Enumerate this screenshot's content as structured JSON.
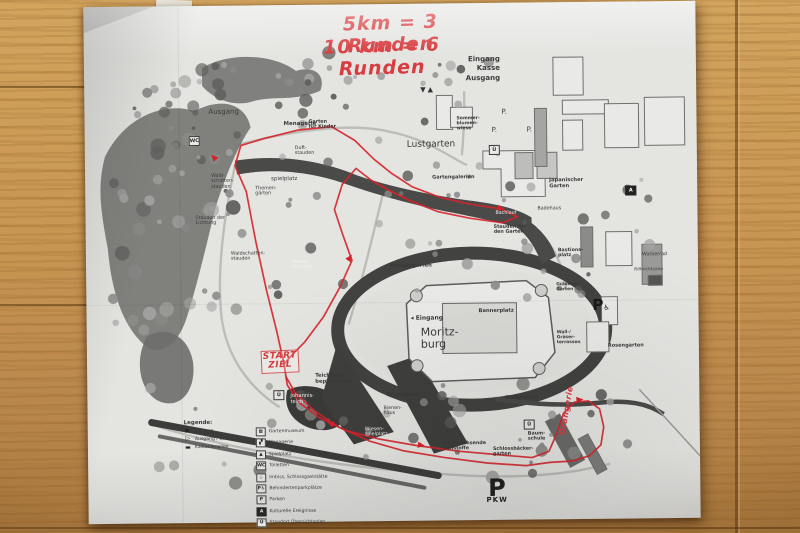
{
  "handwriting": {
    "line1": "5km = 3 Runden",
    "line2": "10 km = 6 Runden",
    "start_ziel": "START\nZIEL",
    "orangerie_note": "Orangerie"
  },
  "colors": {
    "route_red": "#d5232b",
    "handwriting_red": "#d73c40",
    "paper": "#e4e4e1",
    "print_dark": "#3a3a3a",
    "wood": "#c89552"
  },
  "map": {
    "entrance_block": [
      "Eingang",
      "Kasse",
      "Ausgang"
    ],
    "entrance_glyphs": "▼▲",
    "title_castle": "Moritz-\nburg",
    "labels": [
      {
        "t": "Ausgang",
        "x": 124,
        "y": 103,
        "c": "dk",
        "fs": 7
      },
      {
        "t": "Menagerie",
        "x": 199,
        "y": 116,
        "c": "b",
        "fs": 5.5
      },
      {
        "t": "Duft-\nstauden",
        "x": 210,
        "y": 141,
        "c": "",
        "fs": 4.8
      },
      {
        "t": "spielplatz",
        "x": 186,
        "y": 171,
        "c": "",
        "fs": 5.5
      },
      {
        "t": "Themen-\ngärten",
        "x": 170,
        "y": 181,
        "c": "",
        "fs": 4.8
      },
      {
        "t": "Wald-\nschatten-\nstauden",
        "x": 126,
        "y": 168,
        "c": "",
        "fs": 4.8
      },
      {
        "t": "Stauden der\nLichtung",
        "x": 110,
        "y": 210,
        "c": "",
        "fs": 4.8
      },
      {
        "t": "Waldschatten-\nstauden",
        "x": 145,
        "y": 246,
        "c": "",
        "fs": 4.8
      },
      {
        "t": "Rosen/\nStauden",
        "x": 206,
        "y": 255,
        "c": "wh",
        "fs": 4.8
      },
      {
        "t": "Garten\nfür Kinder",
        "x": 224,
        "y": 115,
        "c": "b",
        "fs": 4.8
      },
      {
        "t": "Lustgarten",
        "x": 322,
        "y": 136,
        "c": "",
        "fs": 9
      },
      {
        "t": "Gartengalerien",
        "x": 347,
        "y": 172,
        "c": "b",
        "fs": 5
      },
      {
        "t": "Sommer-\nblumen-\nwiese",
        "x": 372,
        "y": 113,
        "c": "b",
        "fs": 4.6
      },
      {
        "t": "P.",
        "x": 417,
        "y": 106,
        "c": "",
        "fs": 7
      },
      {
        "t": "P.",
        "x": 407,
        "y": 124,
        "c": "",
        "fs": 7
      },
      {
        "t": "P.",
        "x": 442,
        "y": 124,
        "c": "",
        "fs": 7
      },
      {
        "t": "Japanischer\nGarten",
        "x": 464,
        "y": 176,
        "c": "b",
        "fs": 5.2
      },
      {
        "t": "Badehaus",
        "x": 452,
        "y": 204,
        "c": "",
        "fs": 4.8
      },
      {
        "t": "Bachlauf",
        "x": 410,
        "y": 208,
        "c": "wh",
        "fs": 4.8
      },
      {
        "t": "Stauden für\nden Garten",
        "x": 408,
        "y": 222,
        "c": "b",
        "fs": 4.8
      },
      {
        "t": "Bastions-\nplatz",
        "x": 472,
        "y": 246,
        "c": "b",
        "fs": 4.8
      },
      {
        "t": "Wasserrad",
        "x": 556,
        "y": 251,
        "c": "",
        "fs": 4.8
      },
      {
        "t": "Röhrichtzone",
        "x": 548,
        "y": 267,
        "c": "i",
        "fs": 4.4
      },
      {
        "t": "Kräutergarten",
        "x": 304,
        "y": 260,
        "c": "b",
        "fs": 5.2
      },
      {
        "t": "◂ Eingang",
        "x": 324,
        "y": 312,
        "c": "b",
        "fs": 6
      },
      {
        "t": "Moritz-\nburg",
        "x": 334,
        "y": 323,
        "c": "",
        "fs": 11
      },
      {
        "t": "Bannerplatz",
        "x": 392,
        "y": 306,
        "c": "b",
        "fs": 5.2
      },
      {
        "t": "Güldener\nGarten",
        "x": 470,
        "y": 281,
        "c": "b",
        "fs": 4.4
      },
      {
        "t": "Wall-/\nGräser-\nterrassen",
        "x": 470,
        "y": 329,
        "c": "b",
        "fs": 4.4
      },
      {
        "t": "Rosengarten",
        "x": 521,
        "y": 342,
        "c": "b",
        "fs": 5
      },
      {
        "t": "Teichrand-\nbepflanzung",
        "x": 228,
        "y": 369,
        "c": "b",
        "fs": 5.2
      },
      {
        "t": "Johannis-\nteich",
        "x": 203,
        "y": 389,
        "c": "wh",
        "fs": 5.2
      },
      {
        "t": "Obstgarten",
        "x": 299,
        "y": 389,
        "c": "b",
        "fs": 5.2
      },
      {
        "t": "Bienen-\nhaus",
        "x": 296,
        "y": 402,
        "c": "",
        "fs": 4.8
      },
      {
        "t": "Wiesen-\nspielplatz",
        "x": 277,
        "y": 423,
        "c": "wh",
        "fs": 4.8
      },
      {
        "t": "nachwachsende\nRohstoffe",
        "x": 355,
        "y": 438,
        "c": "b",
        "fs": 4.8
      },
      {
        "t": "Schlossbäcker-\ngarten",
        "x": 405,
        "y": 444,
        "c": "b",
        "fs": 4.8
      },
      {
        "t": "Wellgraben",
        "x": 418,
        "y": 393,
        "c": "b",
        "fs": 5.2
      },
      {
        "t": "Baum-\nschule",
        "x": 440,
        "y": 429,
        "c": "b",
        "fs": 4.8
      }
    ],
    "icon_boxes": [
      {
        "g": "WC",
        "x": 104,
        "y": 130,
        "inv": false
      },
      {
        "g": "Ü",
        "x": 404,
        "y": 142,
        "inv": false
      },
      {
        "g": "A",
        "x": 540,
        "y": 184,
        "inv": true
      },
      {
        "g": "Ü",
        "x": 186,
        "y": 385,
        "inv": false
      },
      {
        "g": "Ü",
        "x": 436,
        "y": 417,
        "inv": false
      }
    ],
    "parking_big": {
      "letter": "P",
      "sub": "PKW"
    },
    "parking_handicap": {
      "letter": "P",
      "symbol": "♿"
    },
    "legend": {
      "title": "Legende:",
      "left_items": [
        {
          "icon": "entrance-arrow",
          "glyph": "▶",
          "label": "Eingang"
        },
        {
          "icon": "exit-arrow",
          "glyph": "▷",
          "label": "Ausgang / Übergang"
        },
        {
          "icon": "avenue-line",
          "glyph": "▬",
          "label": "Kastanienallee"
        }
      ],
      "right_items": [
        {
          "icon": "garden-museum",
          "glyph": "▦",
          "label": "Gartenmuseum"
        },
        {
          "icon": "menagerie",
          "glyph": "▞",
          "label": "Menagerie"
        },
        {
          "icon": "playground",
          "glyph": "▲",
          "label": "Spielplatz"
        },
        {
          "icon": "wc",
          "glyph": "WC",
          "label": "Toiletten"
        },
        {
          "icon": "imbiss",
          "glyph": "♨",
          "label": "Imbiss, Schlossgaststätte"
        },
        {
          "icon": "parking-disabled",
          "glyph": "P♿",
          "label": "Behindertenparkplätze"
        },
        {
          "icon": "parking",
          "glyph": "P",
          "label": "Parken"
        },
        {
          "icon": "culture-a",
          "glyph": "A",
          "label": "Kulturelle Ereignisse",
          "inv": true
        },
        {
          "icon": "location-ue",
          "glyph": "Ü",
          "label": "Standort Übersichtsplan"
        }
      ]
    }
  },
  "route": {
    "color": "#d5232b",
    "segments": {
      "west_leg": [
        [
          197,
          359
        ],
        [
          190,
          326
        ],
        [
          180,
          284
        ],
        [
          170,
          236
        ],
        [
          161,
          186
        ],
        [
          150,
          160
        ],
        [
          156,
          140
        ],
        [
          180,
          133
        ],
        [
          214,
          125
        ],
        [
          247,
          122
        ],
        [
          270,
          136
        ],
        [
          289,
          155
        ],
        [
          306,
          169
        ],
        [
          327,
          183
        ],
        [
          355,
          194
        ],
        [
          385,
          201
        ],
        [
          415,
          206
        ],
        [
          432,
          214
        ]
      ],
      "band_return": [
        [
          432,
          214
        ],
        [
          417,
          220
        ],
        [
          384,
          215
        ],
        [
          352,
          208
        ],
        [
          325,
          197
        ],
        [
          305,
          187
        ],
        [
          286,
          176
        ],
        [
          271,
          164
        ],
        [
          257,
          180
        ],
        [
          249,
          205
        ],
        [
          257,
          230
        ],
        [
          266,
          256
        ],
        [
          254,
          282
        ],
        [
          237,
          312
        ],
        [
          218,
          337
        ],
        [
          203,
          352
        ],
        [
          197,
          359
        ]
      ],
      "south_loop_out": [
        [
          197,
          359
        ],
        [
          200,
          380
        ],
        [
          212,
          398
        ],
        [
          232,
          413
        ],
        [
          258,
          426
        ],
        [
          292,
          435
        ],
        [
          330,
          442
        ],
        [
          372,
          448
        ],
        [
          412,
          452
        ],
        [
          444,
          455
        ],
        [
          461,
          449
        ],
        [
          469,
          431
        ],
        [
          476,
          411
        ],
        [
          487,
          400
        ],
        [
          501,
          399
        ],
        [
          512,
          407
        ],
        [
          516,
          425
        ],
        [
          513,
          443
        ],
        [
          501,
          454
        ],
        [
          483,
          459
        ],
        [
          462,
          460
        ]
      ],
      "south_loop_back": [
        [
          462,
          460
        ],
        [
          438,
          463
        ],
        [
          399,
          460
        ],
        [
          356,
          454
        ],
        [
          316,
          447
        ],
        [
          282,
          437
        ],
        [
          252,
          423
        ],
        [
          228,
          407
        ],
        [
          208,
          388
        ],
        [
          199,
          372
        ]
      ]
    },
    "arrows": [
      {
        "x": 131,
        "y": 154,
        "a": 230
      },
      {
        "x": 412,
        "y": 205,
        "a": 8
      },
      {
        "x": 262,
        "y": 256,
        "a": -55
      },
      {
        "x": 330,
        "y": 441,
        "a": 8
      },
      {
        "x": 489,
        "y": 398,
        "a": -5
      },
      {
        "x": 246,
        "y": 420,
        "a": 200
      }
    ]
  }
}
